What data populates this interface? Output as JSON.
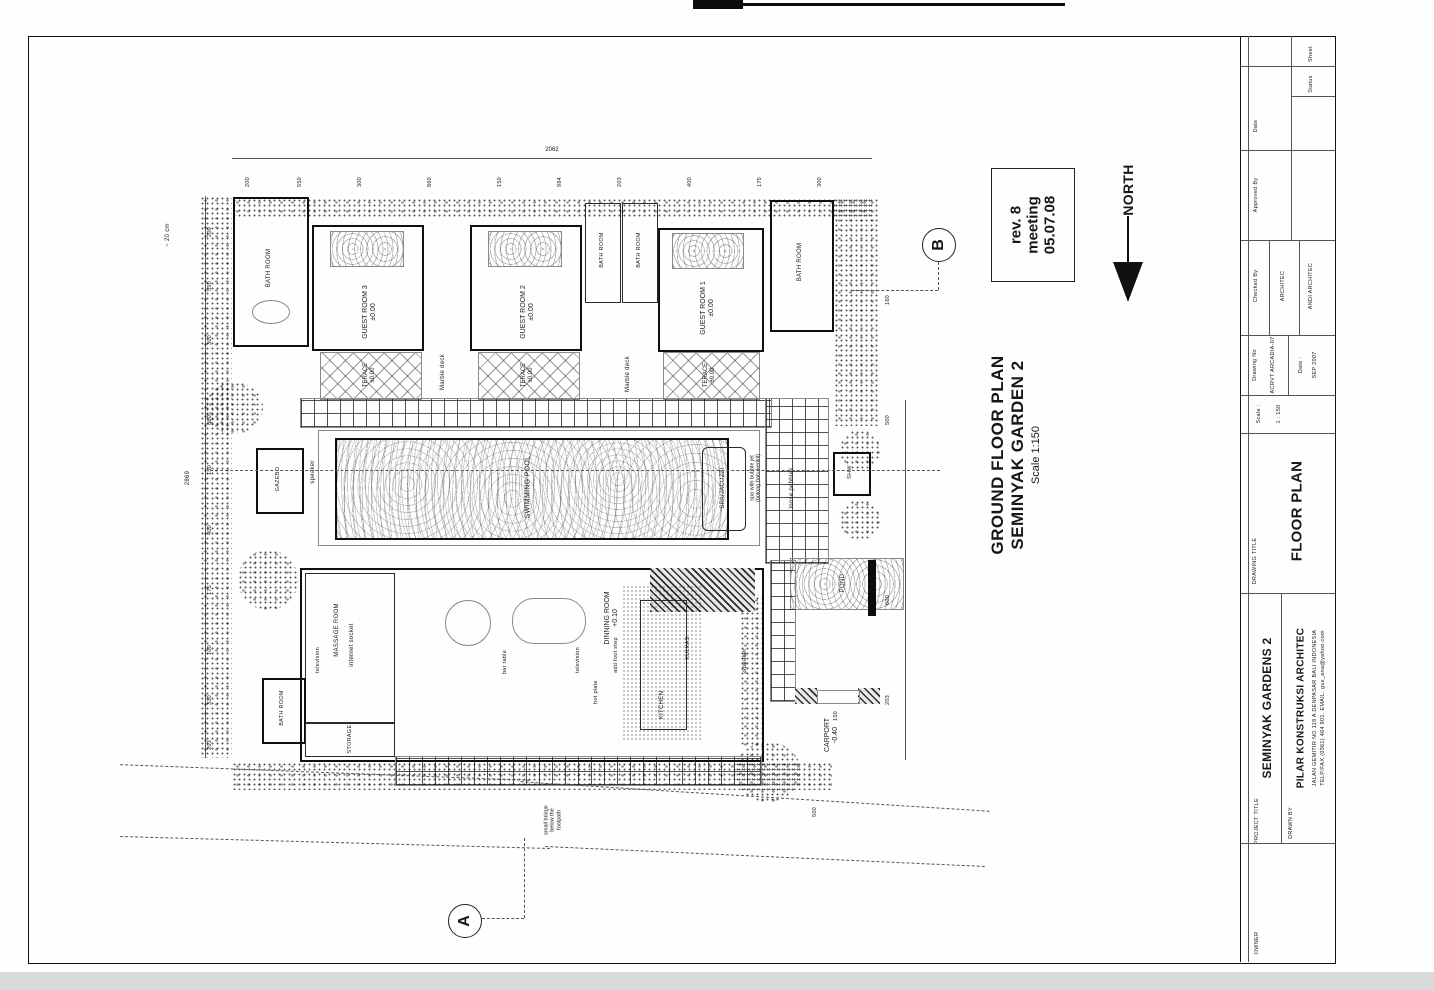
{
  "annotation": {
    "plan_title1": "GROUND FLOOR PLAN",
    "plan_title2": "SEMINYAK GARDEN 2",
    "plan_scale": "Scale 1:150",
    "revision": {
      "l1": "rev. 8",
      "l2": "meeting",
      "l3": "05.07.08"
    },
    "north": "NORTH"
  },
  "plan": {
    "rooms": {
      "bath": "BATH ROOM",
      "guest3": "GUEST ROOM 3",
      "guest2": "GUEST ROOM 2",
      "guest1": "GUEST ROOM 1",
      "lvl0": "±0.00",
      "terace": "TERACE",
      "marble": "Marble deck",
      "pool": "SWIMMING POOL",
      "spa": "SPA/JACUZZI",
      "spa_note1": "spa with bubble jet",
      "spa_note2": "(bolong,batu,kerikil)",
      "pebbles": "loose pebbles",
      "speaker": "speaker",
      "gazebo": "GAZEBO",
      "massage": "MASSAGE ROOM",
      "internet": "internet socket",
      "tv": "television",
      "storage": "STORAGE",
      "dinning": "DINNING ROOM",
      "lvl10": "+0.10",
      "bar": "bar table",
      "hot": "hot plate",
      "foot": "add foot step",
      "kitchen": "KITCHEN",
      "kulkas": "KULKAS",
      "carport": "CARPORT",
      "lvlm40": "-0.40",
      "pond": "POND",
      "shw": "SHW"
    },
    "notes": {
      "bridge1": "small bridge",
      "bridge2": "below the",
      "bridge3": "footpath",
      "cm20": "~ 20 cm"
    },
    "sections": {
      "a": "A",
      "b": "B"
    },
    "dims": {
      "top_total": "2062",
      "left_total": "2869",
      "top": [
        "200",
        "550",
        "300",
        "860",
        "150",
        "984",
        "203",
        "400",
        "175",
        "300"
      ],
      "left": [
        "200",
        "550",
        "300",
        "860",
        "150",
        "400",
        "175",
        "100",
        "330",
        "203"
      ],
      "right": [
        "160",
        "500",
        "600",
        "203"
      ],
      "misc": [
        "150",
        "500"
      ]
    }
  },
  "titleblock": {
    "labels": {
      "date": "Date",
      "approved": "Approved By",
      "checked": "Checked By",
      "sheet": "Sheet",
      "status": "Status",
      "drawing_no": "Drawing No",
      "scale": "Scale :",
      "drawing_title": "DRAWING TITLE",
      "project_title": "PROJECT TITLE",
      "drawn_by": "DRAWN BY",
      "owner": "OWNER",
      "date_lbl": "Date :"
    },
    "values": {
      "architec": "ARCHITEC",
      "architec2": "ANDI ARCHITEC",
      "code": "ACRVT ARCADIA-07",
      "scale_val": "1 : 150",
      "date_val": "SEP 2007",
      "drawing": "FLOOR PLAN",
      "project": "SEMINYAK GARDENS 2",
      "firm": "PILAR KONSTRUKSI ARCHITEC",
      "addr1": "JALAN GEMITIR NO 118 A DENPASAR BALI INDONESIA",
      "addr2": "TELP/FAX (0361) 464 901. EMAIL: gus_ana@yahoo.com"
    }
  }
}
